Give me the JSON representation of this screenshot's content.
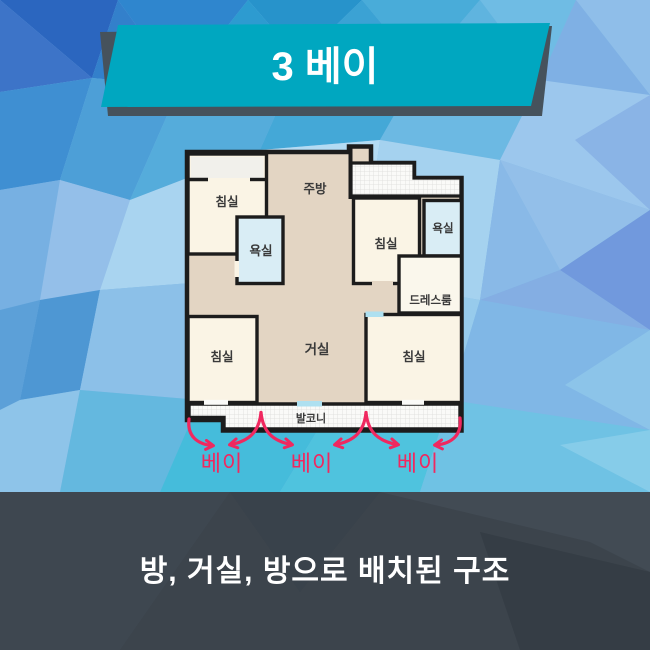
{
  "header": {
    "title": "3 베이"
  },
  "floorplan": {
    "rooms": {
      "bedroom_top_left": "침실",
      "kitchen": "주방",
      "bathroom_left": "욕실",
      "bedroom_right": "침실",
      "bathroom_right": "욕실",
      "dressroom": "드레스룸",
      "bedroom_bottom_left": "침실",
      "living_room": "거실",
      "bedroom_bottom_right": "침실",
      "balcony": "발코니"
    },
    "colors": {
      "room_cream": "#FAF4E5",
      "hall_tan": "#E3D5C3",
      "bathroom_blue": "#D9EDF5",
      "wall": "#1C1C1C"
    }
  },
  "bays": {
    "labels": [
      "베이",
      "베이",
      "베이"
    ],
    "arrow_color": "#F0285F"
  },
  "footer": {
    "caption": "방, 거실, 방으로 배치된 구조"
  },
  "theme": {
    "banner_fill": "#00A7C0",
    "banner_shadow": "#46525C",
    "footer_background": "#3C444C"
  }
}
